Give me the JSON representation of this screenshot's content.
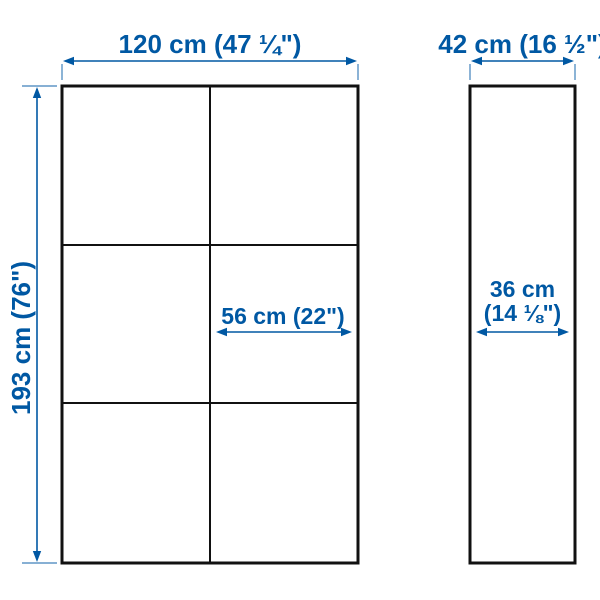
{
  "colors": {
    "dimension_blue": "#0058a3",
    "outline_black": "#111111",
    "background": "#ffffff"
  },
  "diagram": {
    "kind": "furniture-dimension-diagram",
    "front_view": {
      "grid_columns": 2,
      "grid_rows": 3,
      "width": {
        "label": "120 cm (47 ¼\")",
        "cm": 120,
        "inches": "47 ¼"
      },
      "height": {
        "label": "193 cm (76\")",
        "cm": 193,
        "inches": "76"
      },
      "inner_width": {
        "label": "56 cm (22\")",
        "cm": 56,
        "inches": "22"
      }
    },
    "side_view": {
      "depth": {
        "label": "42 cm (16 ½\")",
        "cm": 42,
        "inches": "16 ½"
      },
      "inner_depth": {
        "label_line1": "36 cm",
        "label_line2": "(14 ⅛\")",
        "cm": 36,
        "inches": "14 ⅛"
      }
    }
  }
}
